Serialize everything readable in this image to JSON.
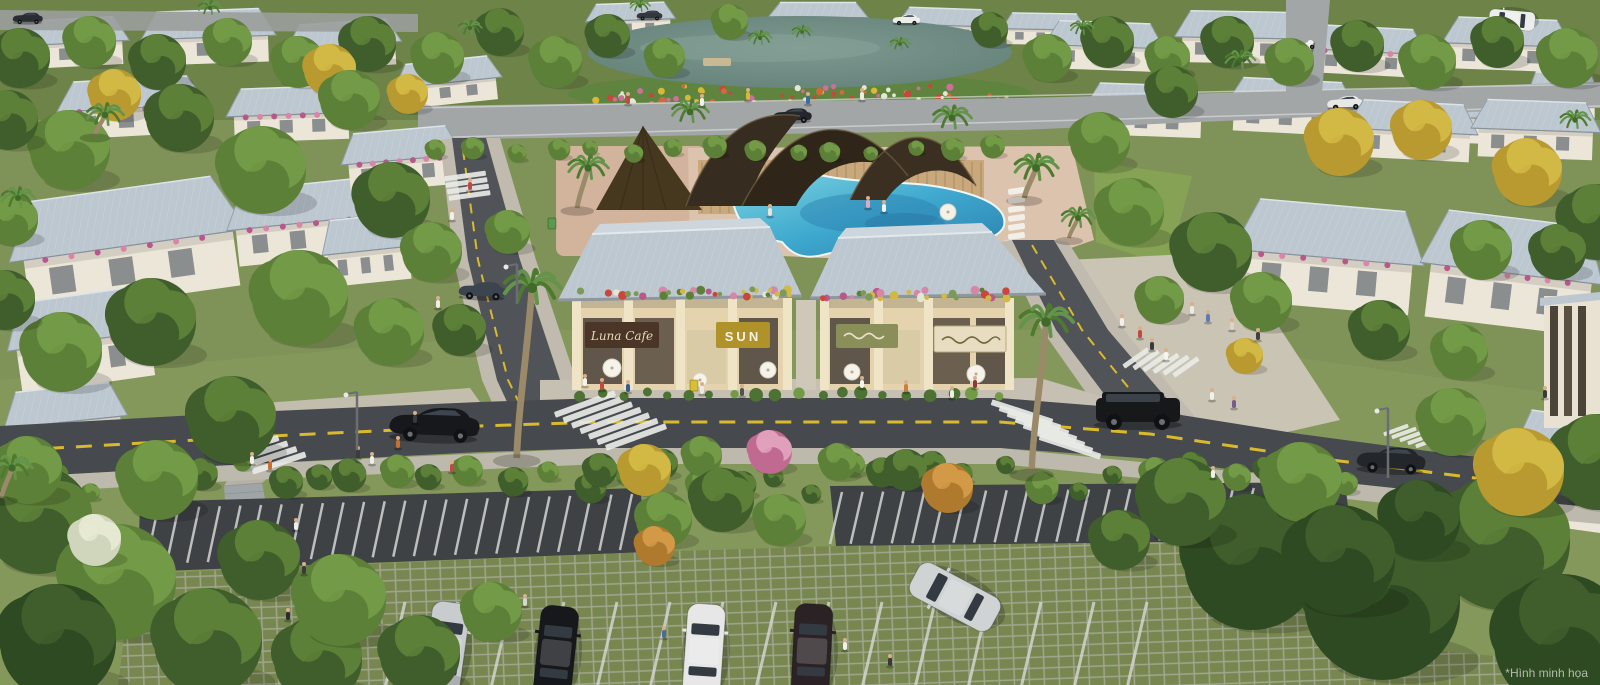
{
  "meta": {
    "kind": "aerial-architectural-render",
    "description": "Aerial render of a resort villa community with central shophouse street, clubhouse pool, lake gardens and grass-grid parking lot"
  },
  "watermark": {
    "text": "*Hình minh họa"
  },
  "signs": {
    "cafe": "Luna Cafe",
    "boutique": "SUN"
  },
  "palette": {
    "ground": "#7f9257",
    "lawn": "#8aa75e",
    "roof": "#bcc7d0",
    "roof_light": "#cdd6dd",
    "wall": "#ece6d9",
    "shop_wall": "#e4d3ac",
    "shop_pilaster": "#efe4c6",
    "storefront": "#61564a",
    "asphalt": "#46494d",
    "asphalt_light": "#a3a6a7",
    "sidewalk": "#c3bdae",
    "plaza": "#cac4b5",
    "boardwalk": "#9fa5a7",
    "road_line": "#d9ba2e",
    "zebra": "#e8eae6",
    "pool": "#3fa9cf",
    "pool_deep": "#2b7fae",
    "pool_light": "#7fd4e0",
    "lake": "#67857c",
    "deck": "#dcc3ae",
    "sand": "#d2b49c",
    "thatch": "#46381f",
    "pavilion": "#332a1d",
    "pavilion_wood": "#c9a87c",
    "grid_cell": "#6e7e4b",
    "grid_line": "#a0a68c",
    "sign_cafe_bg": "#4a3526",
    "sign_cafe_text": "#e9d9b8",
    "sign_sun_bg": "#b0922a",
    "sign_sun_text": "#f6f2e4",
    "sign_olive": "#8a8f5a",
    "sign_cream": "#e8ddc0"
  }
}
